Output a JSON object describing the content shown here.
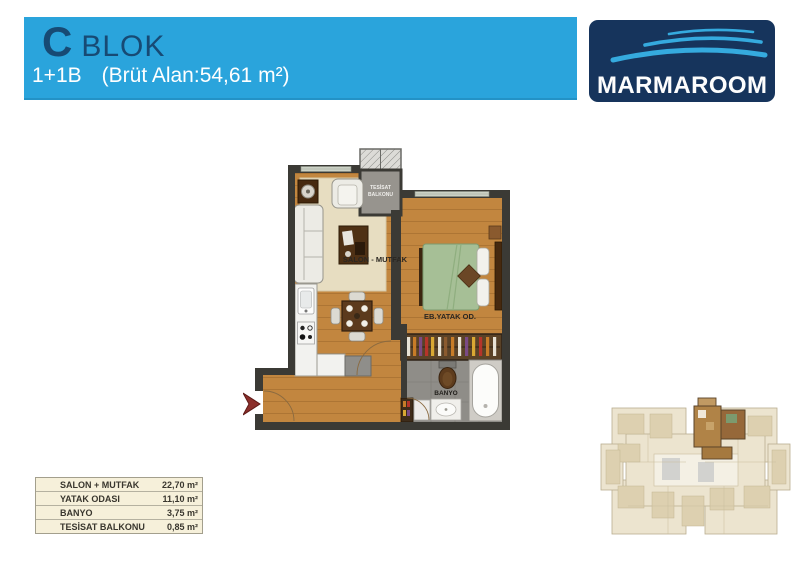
{
  "header": {
    "block_letter": "C",
    "block_word": "BLOK",
    "unit_type": "1+1B",
    "area_label": "(Brüt Alan:54,61 m²)"
  },
  "logo": {
    "brand": "MARMAROOM"
  },
  "plan": {
    "labels": {
      "salon": "SALON - MUTFAK",
      "bedroom": "EB.YATAK OD.",
      "tesisat_line1": "TESİSAT",
      "tesisat_line2": "BALKONU",
      "banyo": "BANYO"
    }
  },
  "areas_table": {
    "rows": [
      {
        "label": "SALON + MUTFAK",
        "value": "22,70 m²"
      },
      {
        "label": "YATAK ODASI",
        "value": "11,10 m²"
      },
      {
        "label": "BANYO",
        "value": "3,75 m²"
      },
      {
        "label": "TESİSAT BALKONU",
        "value": "0,85 m²"
      }
    ]
  },
  "colors": {
    "header_blue": "#2AA4DC",
    "logo_navy": "#16345C",
    "wave_blue": "#35AADE",
    "wall_dark": "#3B3A35",
    "wood_floor": "#C2863F",
    "bed_green": "#A6BF96",
    "bath_gray": "#8F8D88",
    "table_cream": "#F6F0DA",
    "arrow_red": "#8B2F2B"
  }
}
